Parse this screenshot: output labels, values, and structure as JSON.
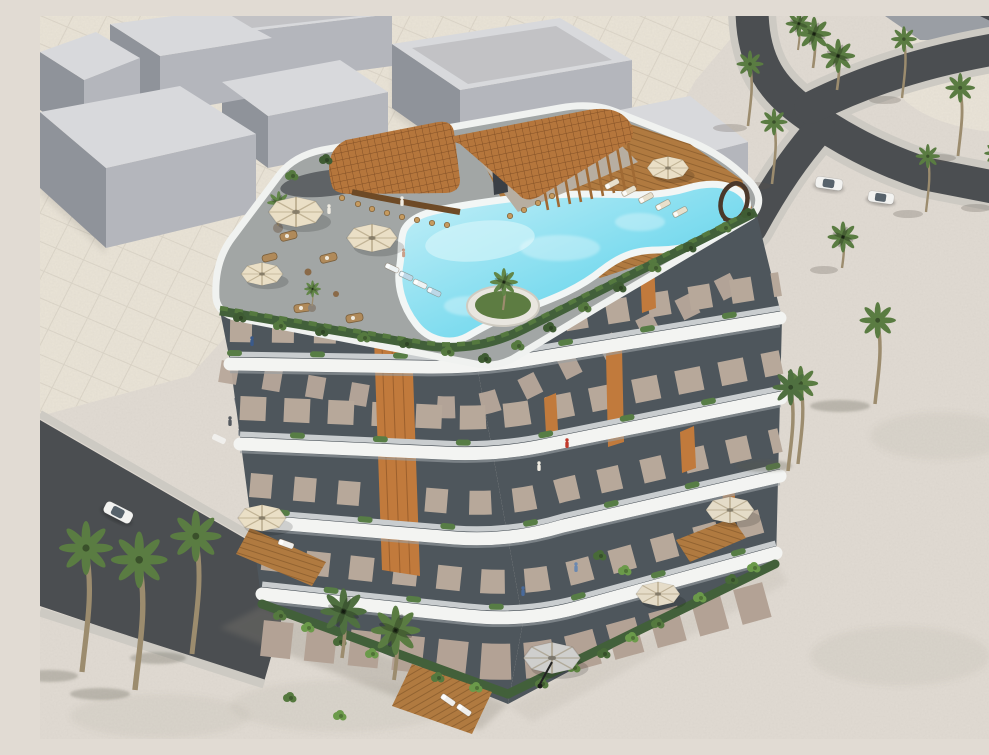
{
  "scene": {
    "type": "3D architectural exterior rendering",
    "view": "aerial three-quarter view from above",
    "subject": "modern curved low-rise residential building with rooftop pool deck",
    "setting": "sandy beachfront plot beside curving asphalt roads, pale tiled plaza and gray massing-model buildings",
    "lighting": "bright daylight, shadows falling to the left"
  },
  "building": {
    "balcony_levels": 4,
    "style": [
      "stacked white wrap-around balcony bands",
      "glass balustrades",
      "beige walls with dark glazing",
      "orange timber slat accents",
      "green planters on balcony edges"
    ],
    "rooftop": {
      "pool": "freeform turquoise pool with island planter palm",
      "island_planter": true,
      "sculpture": "bronze ring sculpture at pool tip",
      "canopy": "L-shaped timber lattice canopy over pool bar",
      "bar_stools": 12,
      "umbrellas": 4,
      "sun_loungers": 9,
      "zones": [
        "stone lounge terrace",
        "timber pool deck",
        "pool bar"
      ]
    },
    "ground_floor": [
      "garden terraces",
      "timber decks",
      "sun loungers",
      "patio umbrellas",
      "perimeter hedges"
    ]
  },
  "environment": {
    "palm_trees_total": 22,
    "massing_boxes": 7,
    "roads": [
      {
        "name": "curving road",
        "location": "top right",
        "cars": 2
      },
      {
        "name": "diagonal road",
        "location": "lower left",
        "cars": 1
      }
    ],
    "vehicles": [
      {
        "type": "car",
        "color": "white",
        "location": "left road"
      },
      {
        "type": "suv",
        "color": "white",
        "location": "right road"
      },
      {
        "type": "sports car",
        "color": "white",
        "location": "right road"
      }
    ],
    "people_visible": 10
  },
  "colors": {
    "sand": "#e1dbd3",
    "plaza": "#eae4d7",
    "asphalt": "#4b4e51",
    "sidewalk": "#cdcac3",
    "box_top": "#d8d9dc",
    "box_side_light": "#b4b6bc",
    "box_side_dark": "#8f939a",
    "glass": "#4e565c",
    "wall": "#b7a89a",
    "wall_ground": "#b3a295",
    "band_white": "#f3f4f2",
    "railing": "#3e464d",
    "balcony_floor": "#c9cdcf",
    "wood_accent": "#c17a3c",
    "canopy_wood": "#b5763c",
    "deck_wood": "#b07a40",
    "terrace_stone": "#a2a6a5",
    "pool_rim": "#f2f6f5",
    "hedge": "#42603a",
    "bush": "#6b9a4a",
    "palm_frond": "#5a7c42",
    "umbrella_cream": "#eadfc6",
    "umbrella_gray": "#cfcfcd",
    "car_white": "#f2f2f0",
    "ring_bronze": "#4a382a"
  }
}
